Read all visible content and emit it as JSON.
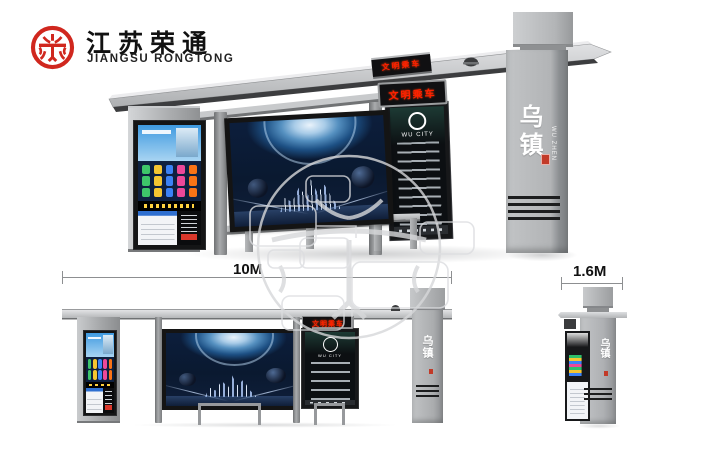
{
  "brand": {
    "name_cn": "江苏荣通",
    "name_en": "JIANGSU RONGTONG"
  },
  "main_view": {
    "roof_led_text": "文明乘车",
    "front_led_text": "文明乘车",
    "pillar": {
      "name_cn": "乌镇",
      "name_en": "WU ZHEN"
    },
    "route_panel": {
      "brand": "WU CITY"
    }
  },
  "front_elevation": {
    "dimension": "10M",
    "led_text": "文明乘车",
    "pillar_name_cn": "乌镇",
    "route_brand": "WU CITY"
  },
  "side_elevation": {
    "dimension": "1.6M",
    "pillar_name_cn": "乌镇"
  },
  "colors": {
    "brand_red": "#d0271e",
    "led_red": "#ff2000",
    "structure_gray": "#b2b4b6",
    "screen_navy": "#0a1930",
    "watermark_gray": "#d7d8da"
  }
}
